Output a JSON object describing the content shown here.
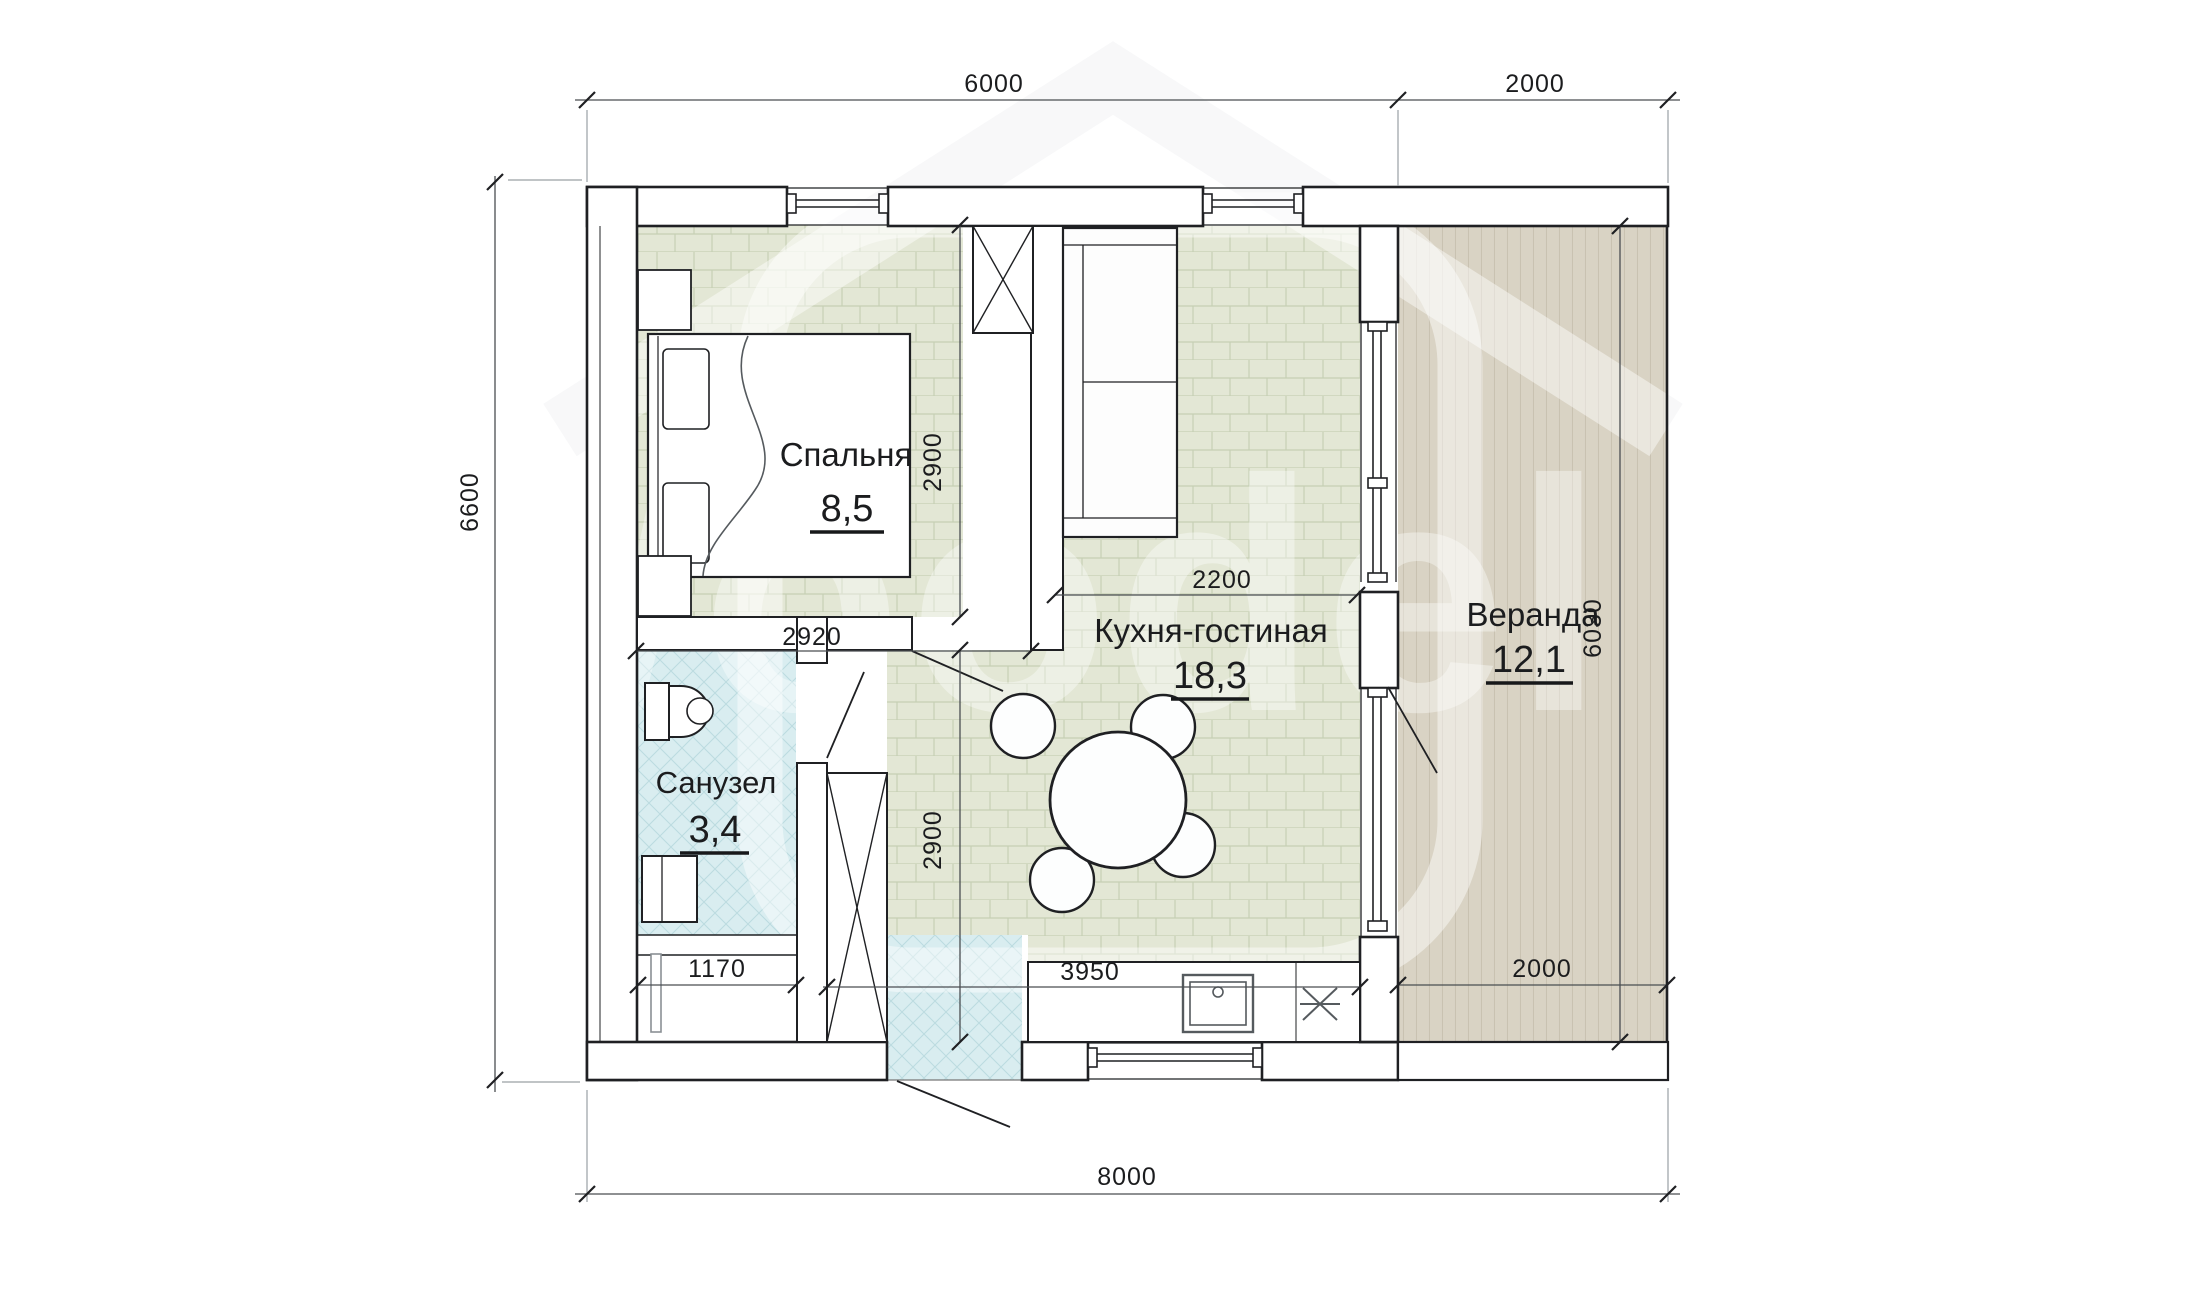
{
  "plan": {
    "rooms": [
      {
        "id": "bedroom",
        "name": "Спальня",
        "area": "8,5"
      },
      {
        "id": "kitchen_living",
        "name": "Кухня-гостиная",
        "area": "18,3"
      },
      {
        "id": "bathroom",
        "name": "Санузел",
        "area": "3,4"
      },
      {
        "id": "veranda",
        "name": "Веранда",
        "area": "12,1"
      }
    ],
    "dimensions": {
      "top_main": "6000",
      "top_veranda": "2000",
      "left_total": "6600",
      "bottom_total": "8000",
      "bedroom_width": "2920",
      "bedroom_depth": "2900",
      "kitchen_width": "2200",
      "kitchen_depth": "2900",
      "bathroom_width": "1170",
      "counter_span": "3950",
      "veranda_width": "2000",
      "veranda_depth": "6030"
    },
    "watermark": "Woodel",
    "colors": {
      "wall_line": "#1f2023",
      "floor_tile_green": "#e3e7d5",
      "floor_tile_cyan": "#d9edf0",
      "veranda_deck": "#d9d3c4",
      "dim_line": "#4a4e52",
      "extension_line": "#9aa0a5"
    }
  }
}
